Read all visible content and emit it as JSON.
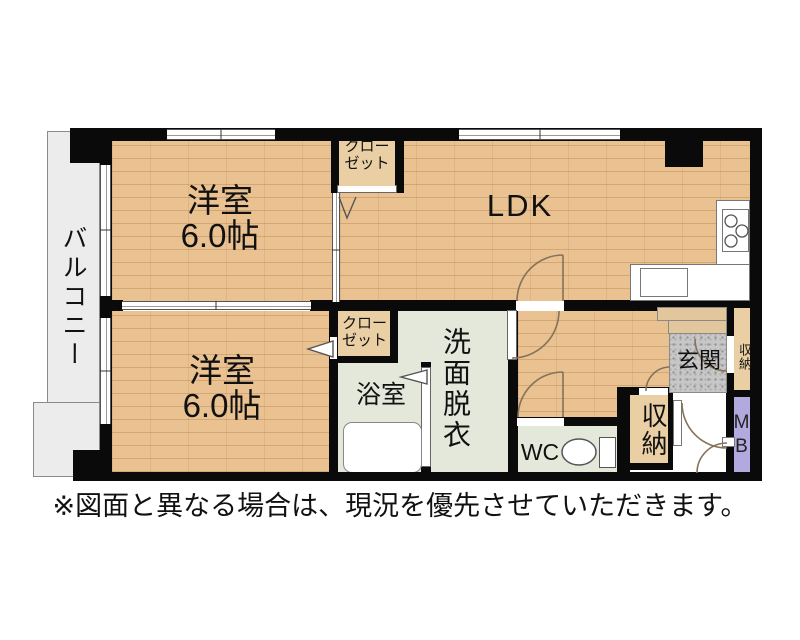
{
  "rooms": {
    "balcony": {
      "label": "バルコニー"
    },
    "western1": {
      "name": "洋室",
      "size": "6.0帖"
    },
    "western2": {
      "name": "洋室",
      "size": "6.0帖"
    },
    "ldk": {
      "label": "LDK"
    },
    "closet_top": {
      "label": "クローゼット"
    },
    "closet_mid": {
      "label": "クローゼット"
    },
    "bath": {
      "label": "浴室"
    },
    "washroom": {
      "label": "洗面脱衣"
    },
    "wc": {
      "label": "WC"
    },
    "storage_hall": {
      "label": "収納"
    },
    "entrance": {
      "label": "玄関"
    },
    "storage_entrance": {
      "label": "収納"
    },
    "meter_box": {
      "label": "MB"
    }
  },
  "footer": {
    "disclaimer": "※図面と異なる場合は、現況を優先させていただきます。"
  },
  "colors": {
    "wall": "#0a0a0a",
    "wood_floor": "#eac291",
    "closet_fill": "#e9cfa3",
    "wet_area_fill": "#e4e8da",
    "entrance_tile": "#c7c7c7",
    "meter_box_fill": "#b2aade",
    "balcony_fill": "#ececec"
  }
}
